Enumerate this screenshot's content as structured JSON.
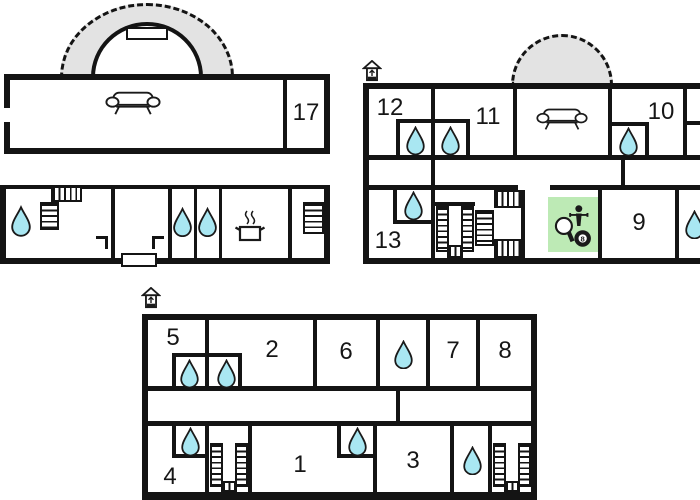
{
  "colors": {
    "background": "#ffffff",
    "wall": "#141414",
    "water-drop": "#a9e7f2",
    "games-room": "#bdeab5",
    "terrace": "#e3e3e3"
  },
  "room_labels": {
    "a17": "17",
    "b12": "12",
    "b11": "11",
    "b10": "10",
    "b13": "13",
    "b9": "9",
    "c5": "5",
    "c2": "2",
    "c6": "6",
    "c7": "7",
    "c8": "8",
    "c4": "4",
    "c1": "1",
    "c3": "3"
  },
  "icons": {
    "eight_ball_label": "8",
    "names": [
      "entrance-icon",
      "sofa-icon",
      "water-drop-icon",
      "kitchen-pot-icon",
      "table-tennis-paddle-icon",
      "foosball-player-icon",
      "eight-ball-icon",
      "staircase",
      "terrace-arch",
      "dome-terrace",
      "door-opening"
    ]
  }
}
